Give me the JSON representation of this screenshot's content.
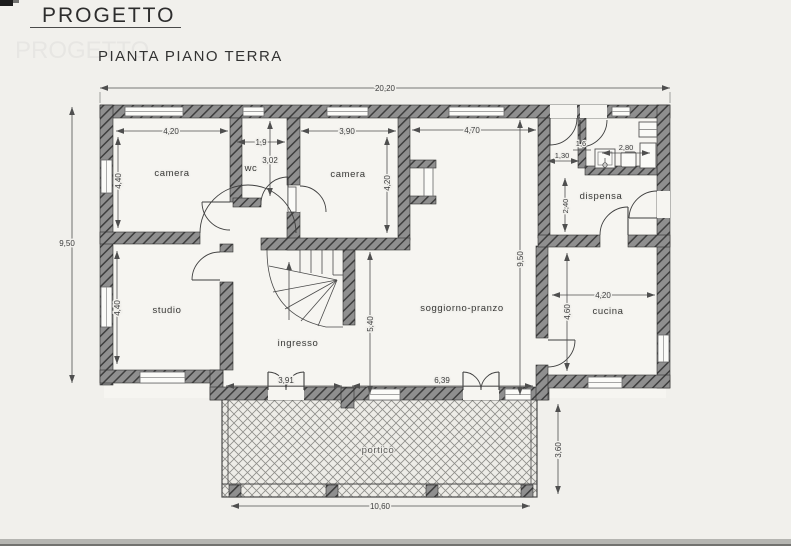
{
  "page": {
    "title": "PROGETTO",
    "subtitle": "PIANTA PIANO TERRA"
  },
  "rooms": {
    "camera_nw": "camera",
    "wc": "wc",
    "camera_n": "camera",
    "dispensa": "dispensa",
    "studio": "studio",
    "ingresso": "ingresso",
    "soggiorno": "soggiorno-pranzo",
    "cucina": "cucina",
    "portico": "portico"
  },
  "dimensions": {
    "total_width": "20,20",
    "total_height": "9,50",
    "camera_nw_width": "4,20",
    "camera_nw_height": "4,40",
    "wc_width": "1,9",
    "wc_height": "3,02",
    "camera_n_width": "3,90",
    "camera_n_height": "4,20",
    "soggiorno_width": "4,70",
    "soggiorno_height": "9,50",
    "hall_width": "1,6",
    "bagno_width": "2,80",
    "hall_depth": "1,30",
    "dispensa_height": "2,40",
    "studio_height": "4,40",
    "ingresso_height": "5,40",
    "cucina_width": "4,20",
    "cucina_height": "4,60",
    "portico_left_span": "3,91",
    "portico_right_span": "6,39",
    "portico_depth": "3,60",
    "portico_width": "10,60"
  }
}
